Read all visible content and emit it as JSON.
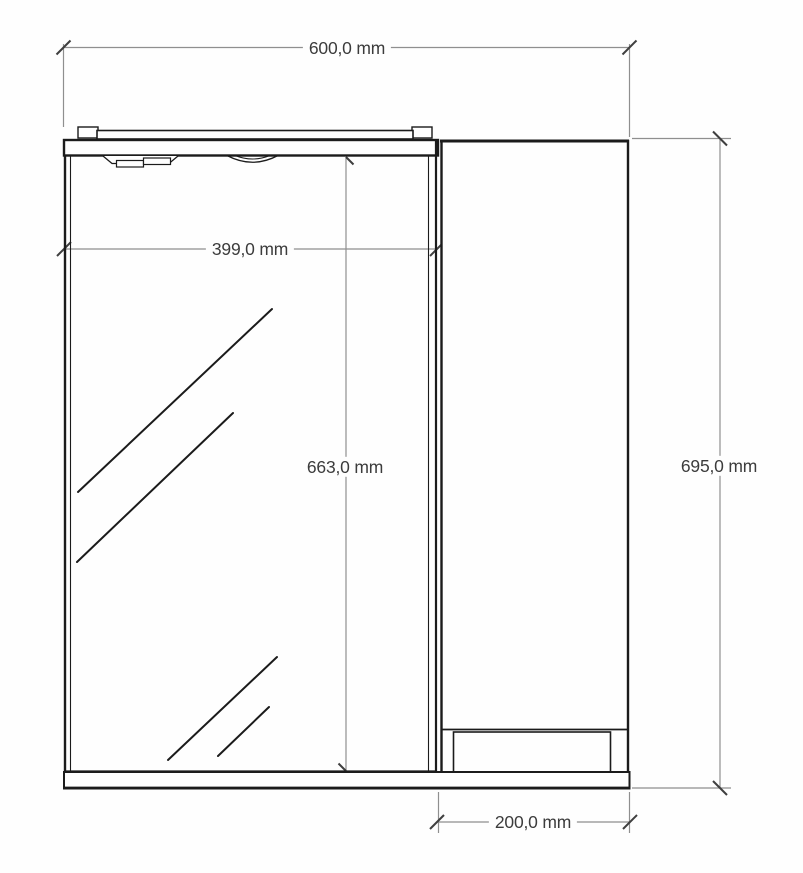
{
  "drawing": {
    "unit": "mm",
    "dimensions": {
      "overall_width": {
        "label": "600,0 mm",
        "value": 600.0
      },
      "door_width": {
        "label": "399,0 mm",
        "value": 399.0
      },
      "door_height": {
        "label": "663,0 mm",
        "value": 663.0
      },
      "overall_height": {
        "label": "695,0 mm",
        "value": 695.0
      },
      "side_width": {
        "label": "200,0 mm",
        "value": 200.0
      }
    }
  }
}
